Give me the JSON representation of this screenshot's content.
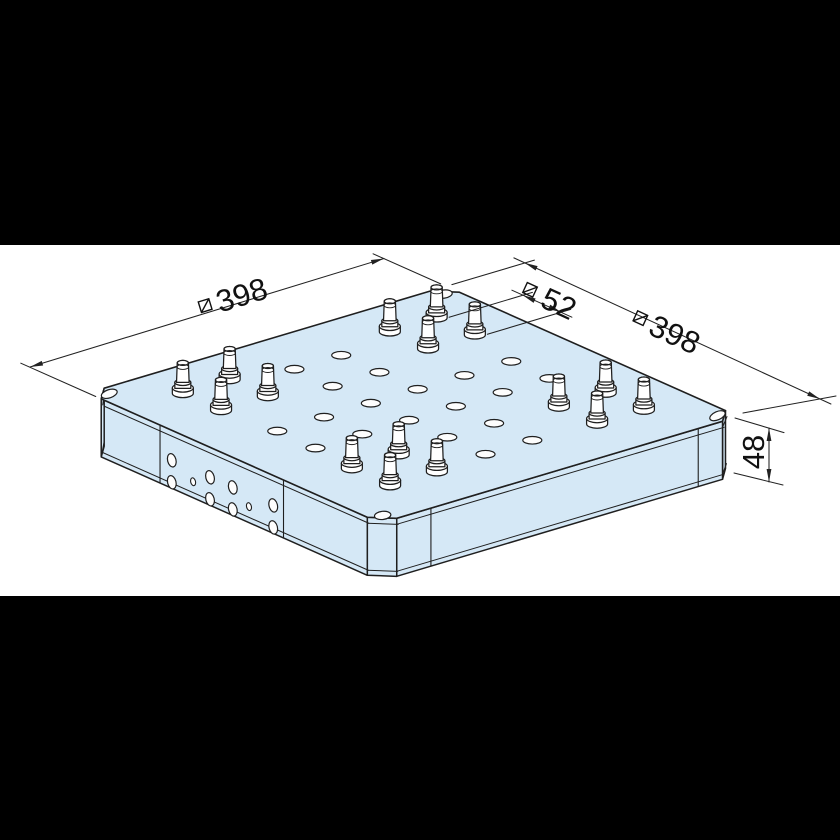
{
  "drawing_title": "isometric view of square clamping baseplate",
  "canvas": {
    "width": 840,
    "height": 840,
    "bg": "#ffffff"
  },
  "letterbox": {
    "color": "#000000",
    "top_height": 245,
    "bottom_y": 596,
    "bottom_height": 244
  },
  "colors": {
    "plate_fill": "#d5e8f6",
    "line": "#1f1f1f",
    "dim_line": "#222222",
    "hole_fill": "#fdfdfd",
    "text": "#111111"
  },
  "projection": {
    "origin": [
      88,
      393
    ],
    "eu": [
      0.9,
      -0.268
    ],
    "ev": [
      0.735,
      0.327
    ],
    "thickness_px": 58
  },
  "plate": {
    "size_mm": 398,
    "height_mm": 48,
    "chamfer_mm": 18,
    "top_outline_mm": [
      [
        18,
        0
      ],
      [
        380,
        0
      ],
      [
        398,
        18
      ],
      [
        398,
        380
      ],
      [
        380,
        398
      ],
      [
        18,
        398
      ],
      [
        0,
        380
      ],
      [
        0,
        18
      ]
    ],
    "visible_faces": [
      {
        "name": "chamfer-east",
        "idx": [
          3,
          4
        ]
      },
      {
        "name": "face-right",
        "idx": [
          4,
          5
        ]
      },
      {
        "name": "chamfer-south",
        "idx": [
          5,
          6
        ]
      },
      {
        "name": "face-left",
        "idx": [
          6,
          7
        ]
      },
      {
        "name": "chamfer-west",
        "idx": [
          7,
          0
        ]
      }
    ],
    "corner_holes_mm": [
      [
        13,
        13
      ],
      [
        385,
        13
      ],
      [
        385,
        385
      ],
      [
        13,
        385
      ]
    ],
    "corner_hole_rot": [
      -18,
      -8,
      -24,
      -6
    ],
    "corner_hole_rx": 8.2,
    "corner_hole_ry": 4.1
  },
  "pins": {
    "cluster_centers_mm": [
      [
        84,
        84
      ],
      [
        314,
        84
      ],
      [
        84,
        314
      ],
      [
        314,
        314
      ]
    ],
    "offset_mm": 26,
    "pitch_mm": 52
  },
  "top_holes": {
    "rx": 9.5,
    "ry": 3.8,
    "positions_mm": [
      [
        69,
        173
      ],
      [
        69,
        225
      ],
      [
        121,
        173
      ],
      [
        121,
        225
      ],
      [
        173,
        69
      ],
      [
        173,
        121
      ],
      [
        173,
        173
      ],
      [
        173,
        225
      ],
      [
        173,
        277
      ],
      [
        173,
        329
      ],
      [
        225,
        69
      ],
      [
        225,
        121
      ],
      [
        225,
        173
      ],
      [
        225,
        225
      ],
      [
        225,
        277
      ],
      [
        225,
        329
      ],
      [
        277,
        173
      ],
      [
        277,
        225
      ],
      [
        329,
        173
      ],
      [
        329,
        225
      ]
    ]
  },
  "side_detail": {
    "left_divider_v_mm": [
      98,
      266
    ],
    "right_divider_u_mm": [
      56,
      353
    ],
    "left_hole_columns": [
      {
        "v_mm": 114,
        "type": "pair"
      },
      {
        "v_mm": 143,
        "type": "small"
      },
      {
        "v_mm": 166,
        "type": "pair"
      },
      {
        "v_mm": 197,
        "type": "pair"
      },
      {
        "v_mm": 219,
        "type": "small"
      },
      {
        "v_mm": 252,
        "type": "pair"
      }
    ],
    "pair_depths_px": [
      30,
      52
    ],
    "small_depth_px": 42,
    "pair_hole": {
      "rx": 4.2,
      "ry": 6.8,
      "rot": -14
    },
    "small_hole": {
      "rx": 2.4,
      "ry": 4.0,
      "rot": -14
    },
    "top_band_offset": 6,
    "bottom_band_offset": 5
  },
  "dimensions": [
    {
      "name": "plate-width-left",
      "value": "398",
      "symbol": "squared-diagonal",
      "line": [
        [
          30,
          367
        ],
        [
          384,
          258.5
        ]
      ],
      "arrows": [
        [
          30,
          367,
          163
        ],
        [
          384,
          258.5,
          -17
        ]
      ],
      "extensions": [
        [
          [
            95.7,
            396.5
          ],
          [
            20.8,
            363.2
          ]
        ],
        [
          [
            440.7,
            283.9
          ],
          [
            373.1,
            253.8
          ]
        ]
      ],
      "label": {
        "x": 230,
        "y": 298,
        "rot": -17,
        "text_dx": 12,
        "sym_dx": -26
      }
    },
    {
      "name": "plate-width-right",
      "value": "398",
      "symbol": "squared-diagonal",
      "line": [
        [
          513.9,
          257.9
        ],
        [
          830.9,
          404
        ]
      ],
      "arrows": [
        [
          524.8,
          262.9,
          204.7
        ],
        [
          820,
          399,
          24.7
        ]
      ],
      "extensions": [
        [
          [
            451.9,
            284.6
          ],
          [
            534.4,
            260.1
          ]
        ],
        [
          [
            743,
            413
          ],
          [
            836,
            396
          ]
        ]
      ],
      "label": {
        "x": 664,
        "y": 329,
        "rot": 24.7,
        "text_dx": 12,
        "sym_dx": -26
      }
    },
    {
      "name": "pin-pitch",
      "value": "52",
      "symbol": "squared-diagonal",
      "line": [
        [
          511.9,
          290.2
        ],
        [
          571.9,
          317.2
        ]
      ],
      "arrows": [
        [
          522.8,
          295.3,
          204.7
        ],
        [
          561.1,
          312.3,
          24.7
        ]
      ],
      "extensions": [
        [
          [
            449.1,
            317.2
          ],
          [
            532.4,
            292.4
          ]
        ],
        [
          [
            487.4,
            334.2
          ],
          [
            570.7,
            309.4
          ]
        ]
      ],
      "label": {
        "x": 550,
        "y": 299,
        "rot": 24.7,
        "text_dx": 10,
        "sym_dx": -22
      }
    },
    {
      "name": "plate-height",
      "value": "48",
      "symbol": null,
      "line": [
        [
          769,
          428
        ],
        [
          769,
          482
        ]
      ],
      "arrows": [
        [
          769,
          428,
          -90
        ],
        [
          769,
          482,
          90
        ]
      ],
      "extensions": [
        [
          [
            735,
            418
          ],
          [
            784,
            432.6
          ]
        ],
        [
          [
            734,
            473
          ],
          [
            783,
            485
          ]
        ]
      ],
      "label": {
        "x": 753,
        "y": 452,
        "rot": -90,
        "text_dx": 0,
        "sym_dx": 0
      }
    }
  ]
}
